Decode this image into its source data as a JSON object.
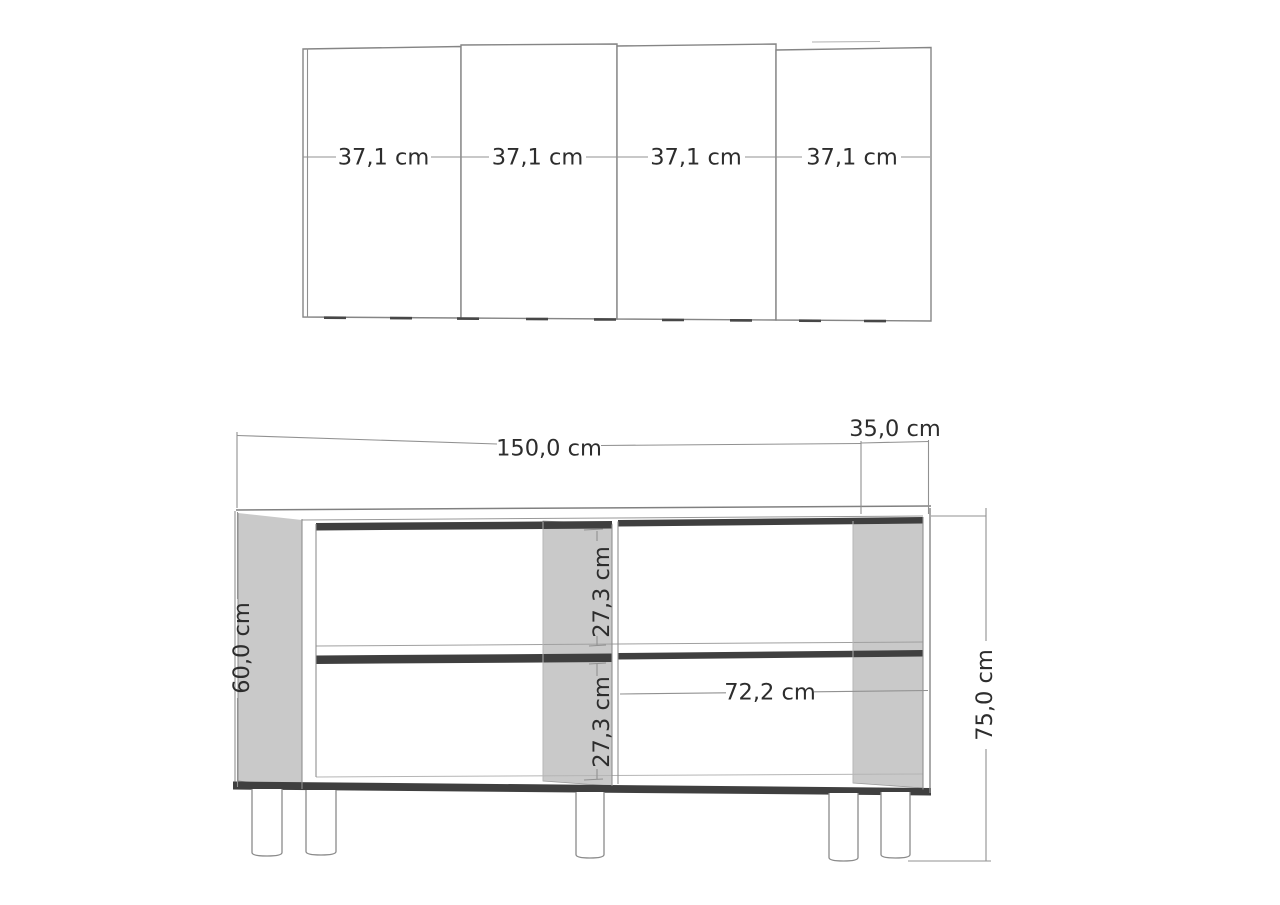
{
  "front_view": {
    "door_count": 4,
    "door_width_labels": [
      "37,1 cm",
      "37,1 cm",
      "37,1 cm",
      "37,1 cm"
    ]
  },
  "cabinet_view": {
    "width_label": "150,0 cm",
    "depth_label": "35,0 cm",
    "total_height_label": "75,0 cm",
    "side_height_label": "60,0 cm",
    "top_compartment_label": "27,3 cm",
    "bottom_compartment_label": "27,3 cm",
    "inner_width_label": "72,2 cm",
    "visible_leg_count": 5
  },
  "colors": {
    "background": "#ffffff",
    "panel_fill": "#c9c9c9",
    "shadow": "#3f3f3f",
    "line": "#8a8a8a",
    "dimension_line": "#919191",
    "text": "#2d2d2d"
  }
}
